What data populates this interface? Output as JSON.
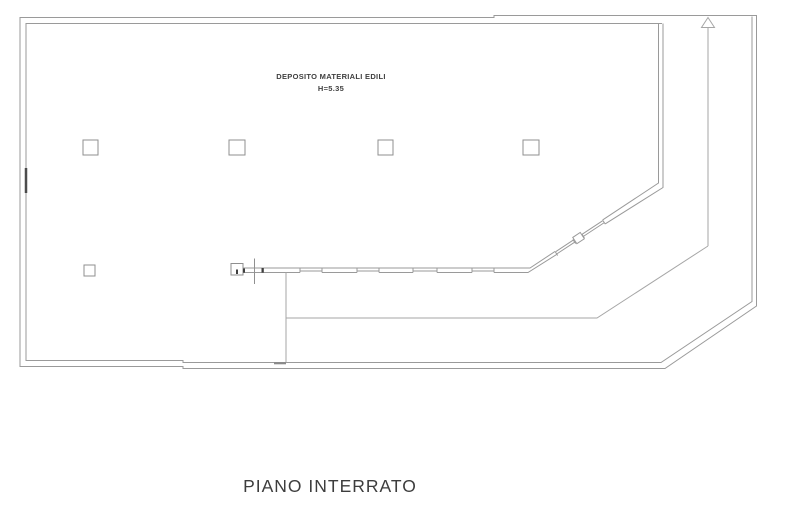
{
  "plan": {
    "title": "PIANO INTERRATO",
    "room": {
      "name": "DEPOSITO MATERIALI EDILI",
      "height": "H=5.35"
    },
    "colors": {
      "wall_line": "#9a9a9a",
      "ramp_line": "#a6a6a6",
      "detail_dark": "#4c4c4c",
      "text": "#3d3d3d",
      "background": "#ffffff"
    },
    "features": {
      "columns_visible": 6,
      "wall_openings_visible": 6,
      "direction_arrow": "up"
    }
  }
}
